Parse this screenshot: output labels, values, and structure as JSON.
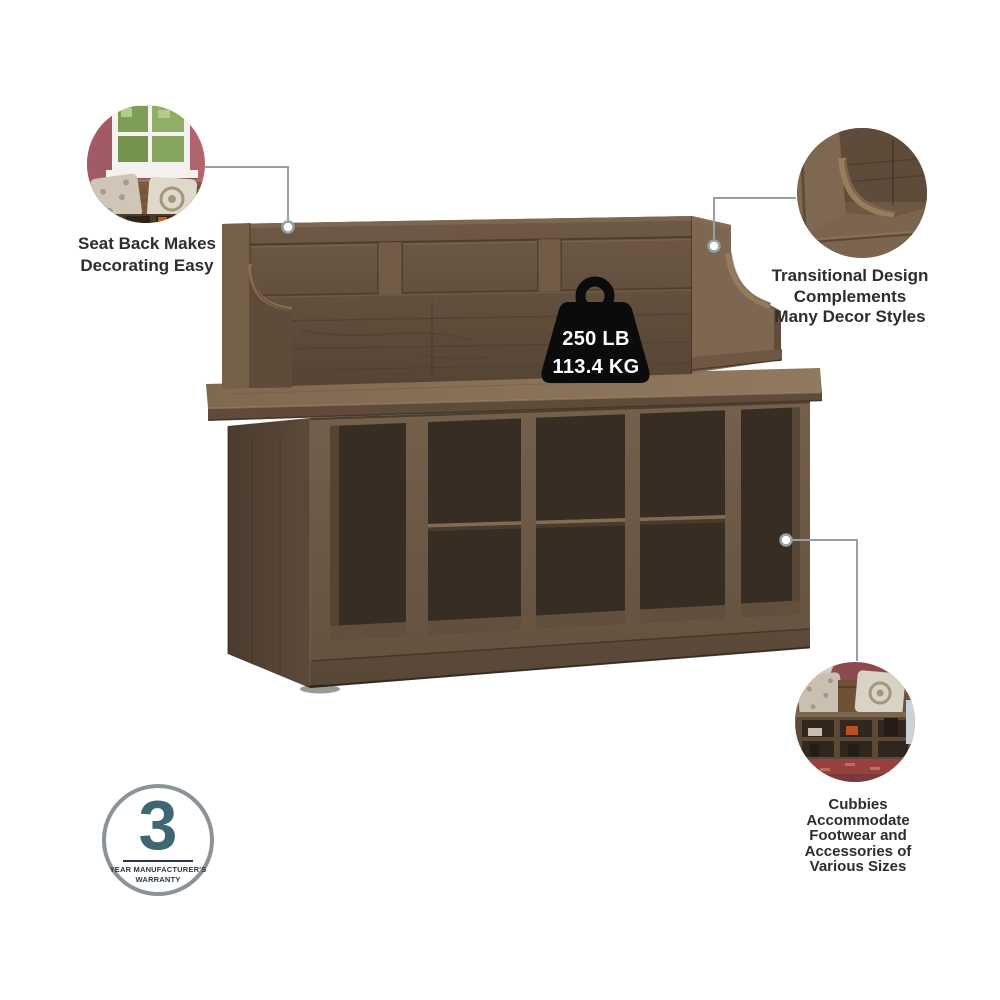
{
  "callouts": {
    "seat_back": {
      "lines": [
        "Seat Back Makes",
        "Decorating Easy"
      ]
    },
    "transitional": {
      "lines": [
        "Transitional Design",
        "Complements",
        "Many Decor Styles"
      ]
    },
    "cubbies": {
      "lines": [
        "Cubbies",
        "Accommodate",
        "Footwear and",
        "Accessories of",
        "Various Sizes"
      ]
    }
  },
  "weight_capacity": {
    "pounds": "250 LB",
    "kilograms": "113.4 KG"
  },
  "warranty_badge": {
    "years": "3",
    "caption_line1": "YEAR MANUFACTURER'S",
    "caption_line2": "WARRANTY"
  },
  "colors": {
    "background": "#ffffff",
    "wood_mid": "#6e5a46",
    "wood_dark": "#4e3e30",
    "wood_light": "#8a745a",
    "cubby_interior": "#382d23",
    "leader_line": "#97a0a4",
    "text": "#2d2d2d",
    "weight_icon": "#0b0b0b",
    "warranty_teal": "#3f6673",
    "inset_wall_pink": "#b3656f",
    "inset_wall_maroon": "#8d4950"
  }
}
